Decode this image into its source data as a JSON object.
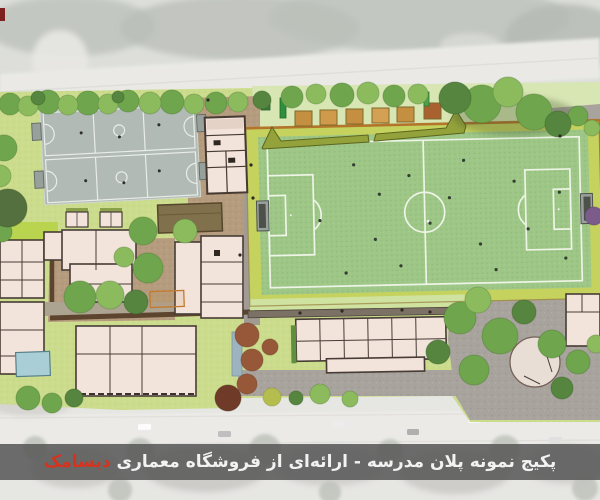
{
  "caption": {
    "main": "پکیج نمونه پلان مدرسه - ارائه‌ای از فروشگاه معماری",
    "brand": "دیسامک"
  },
  "colors": {
    "caption_bar": "rgba(88,88,88,0.87)",
    "caption_text": "#f2f2f2",
    "brand_red": "#d6331f",
    "pitch_green": "#9dc687",
    "pitch_line": "#eef4e6",
    "pitch_margin": "#c5d35e",
    "pitch_border_orange": "#b2752b",
    "court_gray": "#b1bab4",
    "court_line": "#e9ece8",
    "building_fill": "#f2e3db",
    "building_stroke": "#473c36",
    "lawn_green": "#ccdc8d",
    "hedge_olive": "#93a23b",
    "garden_bed_tan": "#c58f42",
    "paving_brown": "#b69c7e",
    "paving_gray": "#a8a39d",
    "pool_blue": "#a9ced6",
    "photo_fade_gray": "#d2d1cd"
  }
}
